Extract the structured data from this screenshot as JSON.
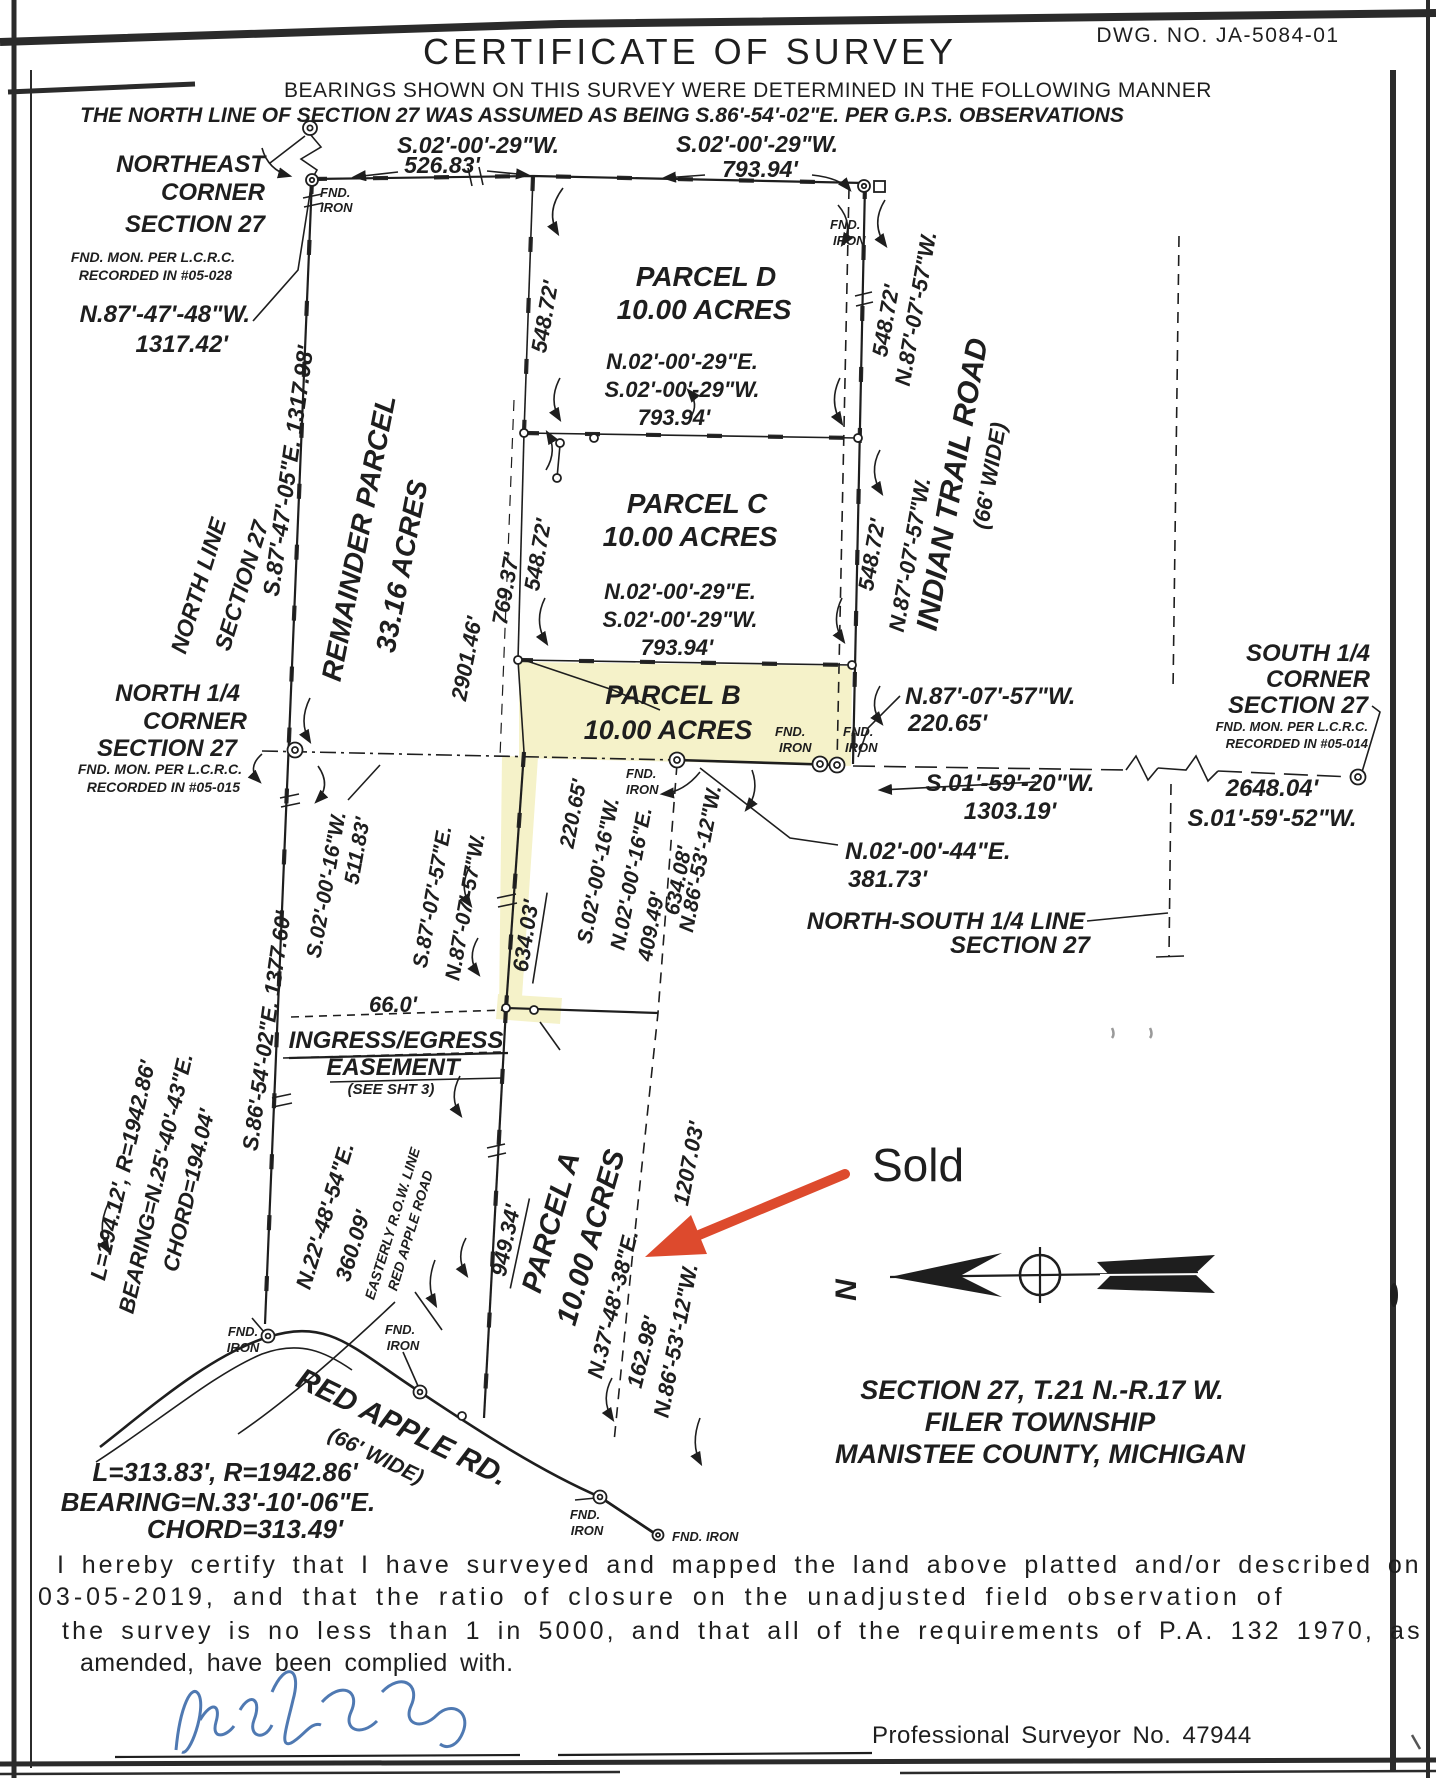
{
  "header": {
    "dwg_no": "DWG. NO. JA-5084-01",
    "title": "CERTIFICATE OF SURVEY",
    "note1": "BEARINGS SHOWN ON THIS SURVEY WERE DETERMINED IN THE FOLLOWING MANNER",
    "note2": "THE NORTH LINE OF SECTION 27 WAS ASSUMED AS BEING S.86'-54'-02\"E. PER G.P.S. OBSERVATIONS"
  },
  "map": {
    "corners": {
      "northeast": {
        "l1": "NORTHEAST",
        "l2": "CORNER",
        "l3": "SECTION 27",
        "l4": "FND. MON. PER L.C.R.C.",
        "l5": "RECORDED IN #05-028",
        "tie_bearing": "N.87'-47'-48\"W.",
        "tie_distance": "1317.42'"
      },
      "north_quarter": {
        "l1": "NORTH 1/4",
        "l2": "CORNER",
        "l3": "SECTION 27",
        "l4": "FND. MON. PER L.C.R.C.",
        "l5": "RECORDED IN #05-015"
      },
      "south_quarter": {
        "l1": "SOUTH 1/4",
        "l2": "CORNER",
        "l3": "SECTION 27",
        "l4": "FND. MON. PER L.C.R.C.",
        "l5": "RECORDED IN #05-014",
        "distance": "2648.04'",
        "bearing": "S.01'-59'-52\"W."
      }
    },
    "parcels": {
      "remainder": {
        "name": "REMAINDER PARCEL",
        "area": "33.16 ACRES"
      },
      "a": {
        "name": "PARCEL A",
        "area": "10.00 ACRES"
      },
      "b": {
        "name": "PARCEL B",
        "area": "10.00 ACRES"
      },
      "c": {
        "name": "PARCEL C",
        "area": "10.00 ACRES"
      },
      "d": {
        "name": "PARCEL D",
        "area": "10.00 ACRES"
      }
    },
    "dims": {
      "s02_00_29": "S.02'-00'-29\"W.",
      "n02_00_29": "N.02'-00'-29\"E.",
      "d526": "526.83'",
      "d793": "793.94'",
      "d548": "548.72'",
      "d769": "769.37'",
      "d2901": "2901.46'",
      "north_line_bearing": "S.87'-47'-05\"E. 1317.98'",
      "west_bearing": "S.86'-54'-02\"E. 1377.60'",
      "s02_00_16": "S.02'-00'-16\"W.",
      "n02_00_16": "N.02'-00'-16\"E.",
      "d511": "511.83'",
      "d220": "220.65'",
      "d634_03": "634.03'",
      "d634_08": "634.08'",
      "d409": "409.49'",
      "n86_53_12": "N.86'-53'-12\"W.",
      "d949": "949.34'",
      "n37_48_38": "N.37'-48'-38\"E.",
      "d162": "162.98'",
      "d1207": "1207.03'",
      "n22_48_54": "N.22'-48'-54\"E.",
      "d360": "360.09'",
      "n87_07_57": "N.87'-07'-57\"W.",
      "s87_07_57": "S.87'-07'-57\"E.",
      "n02_00_44": "N.02'-00'-44\"E.",
      "d381": "381.73'",
      "s01_59_20": "S.01'-59'-20\"W.",
      "d1303": "1303.19'",
      "d66": "66.0'"
    },
    "monuments": {
      "fnd": "FND.",
      "iron": "IRON",
      "fnd_iron": "FND. IRON"
    },
    "lines_labels": {
      "north_line1": "NORTH LINE",
      "north_line2": "SECTION 27",
      "ns1": "NORTH-SOUTH 1/4 LINE",
      "ns2": "SECTION 27"
    },
    "roads": {
      "indian_trail": "INDIAN TRAIL ROAD",
      "indian_width": "(66' WIDE)",
      "red_apple": "RED APPLE RD.",
      "red_apple_width": "(66' WIDE)",
      "row1": "EASTERLY R.O.W. LINE",
      "row2": "RED APPLE ROAD"
    },
    "easement": {
      "l1": "INGRESS/EGRESS",
      "l2": "EASEMENT",
      "l3": "(SEE SHT 3)"
    },
    "curves": {
      "c1_length": "L=194.12', R=1942.86'",
      "c1_bearing": "BEARING=N.25'-40'-43\"E.",
      "c1_chord": "CHORD=194.04'",
      "c2_length": "L=313.83', R=1942.86'",
      "c2_bearing": "BEARING=N.33'-10'-06\"E.",
      "c2_chord": "CHORD=313.49'"
    },
    "north_arrow_label": "N",
    "location": {
      "l1": "SECTION 27, T.21 N.-R.17 W.",
      "l2": "FILER TOWNSHIP",
      "l3": "MANISTEE COUNTY, MICHIGAN"
    },
    "annotation": {
      "sold": "Sold"
    }
  },
  "certification": {
    "l1": "I hereby certify that I have surveyed and mapped the land above platted and/or described on",
    "l2": "03-05-2019,  and that the ratio of closure on the unadjusted field observation of",
    "l3": "the survey is no less than 1 in 5000, and that all of the requirements of P.A. 132 1970, as",
    "l4": "amended, have been complied with."
  },
  "signature": {
    "surveyor_no": "Professional Surveyor No. 47944"
  },
  "colors": {
    "ink": "#1e1e1e",
    "highlight": "#f3efbc",
    "annotation_red": "#dd4a2d",
    "signature_blue": "#4672ae",
    "paper": "#ffffff"
  }
}
